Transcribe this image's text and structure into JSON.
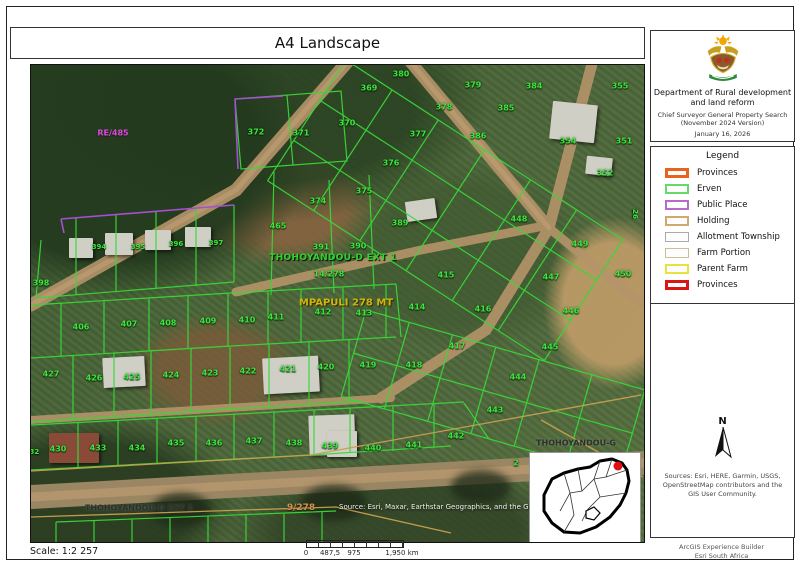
{
  "page": {
    "title": "A4 Landscape",
    "scale_label": "Scale: 1:2 257",
    "footer_right_line1": "ArcGIS Experience Builder",
    "footer_right_line2": "Esri South Africa"
  },
  "header_panel": {
    "department_line1": "Department of Rural development",
    "department_line2": "and land reform",
    "subtitle_line1": "Chief Surveyor General Property Search",
    "subtitle_line2": "(November 2024 Version)",
    "date": "January 16, 2026"
  },
  "legend": {
    "title": "Legend",
    "items": [
      {
        "label": "Provinces",
        "stroke": "#e8641e",
        "weight": 3
      },
      {
        "label": "Erven",
        "stroke": "#66d966",
        "weight": 2
      },
      {
        "label": "Public Place",
        "stroke": "#b36cc8",
        "weight": 2
      },
      {
        "label": "Holding",
        "stroke": "#d2a96c",
        "weight": 2
      },
      {
        "label": "Allotment Township",
        "stroke": "#aaaaaa",
        "weight": 1
      },
      {
        "label": "Farm Portion",
        "stroke": "#ccbf96",
        "weight": 1
      },
      {
        "label": "Parent Farm",
        "stroke": "#e8e23c",
        "weight": 2
      },
      {
        "label": "Provinces",
        "stroke": "#dd1414",
        "weight": 3
      }
    ]
  },
  "north_label": "N",
  "sources_text": "Sources: Esri, HERE, Garmin, USGS, OpenStreetMap contributors and the GIS User Community.",
  "scalebar": {
    "labels": [
      {
        "t": "0",
        "p": 0
      },
      {
        "t": "487,5",
        "p": 0.25
      },
      {
        "t": "975",
        "p": 0.5
      },
      {
        "t": "1,950 km",
        "p": 1
      }
    ]
  },
  "colors": {
    "erven_line": "#38d838",
    "public_place_line": "#a54fd2",
    "farm_line": "#c8a050",
    "parcel_label": "#3fe53f",
    "farm_name_label": "#cdb70f",
    "farm_portion_label": "#d8914d",
    "public_place_label": "#d54fd5"
  },
  "map": {
    "attribution": "Source: Esri, Maxar, Earthstar Geographics, and the GIS Use",
    "labels": [
      {
        "t": "380",
        "x": 370,
        "y": 9
      },
      {
        "t": "369",
        "x": 338,
        "y": 23
      },
      {
        "t": "379",
        "x": 442,
        "y": 20
      },
      {
        "t": "384",
        "x": 503,
        "y": 21
      },
      {
        "t": "355",
        "x": 589,
        "y": 21
      },
      {
        "t": "378",
        "x": 413,
        "y": 42
      },
      {
        "t": "385",
        "x": 475,
        "y": 43
      },
      {
        "t": "370",
        "x": 316,
        "y": 58
      },
      {
        "t": "372",
        "x": 225,
        "y": 67
      },
      {
        "t": "371",
        "x": 270,
        "y": 68
      },
      {
        "t": "377",
        "x": 387,
        "y": 69
      },
      {
        "t": "386",
        "x": 447,
        "y": 71
      },
      {
        "t": "354",
        "x": 537,
        "y": 76
      },
      {
        "t": "351",
        "x": 593,
        "y": 76
      },
      {
        "t": "376",
        "x": 360,
        "y": 98
      },
      {
        "t": "352",
        "x": 574,
        "y": 108
      },
      {
        "t": "375",
        "x": 333,
        "y": 126
      },
      {
        "t": "374",
        "x": 287,
        "y": 136
      },
      {
        "t": "26",
        "x": 604,
        "y": 149,
        "r": 90,
        "s": 7
      },
      {
        "t": "RE/485",
        "x": 82,
        "y": 68,
        "c": "m",
        "n": "public-place-label"
      },
      {
        "t": "465",
        "x": 247,
        "y": 161
      },
      {
        "t": "389",
        "x": 369,
        "y": 158
      },
      {
        "t": "448",
        "x": 488,
        "y": 154
      },
      {
        "t": "391",
        "x": 290,
        "y": 182
      },
      {
        "t": "390",
        "x": 327,
        "y": 181
      },
      {
        "t": "449",
        "x": 549,
        "y": 179
      },
      {
        "t": "394",
        "x": 68,
        "y": 182,
        "s": 7
      },
      {
        "t": "395",
        "x": 107,
        "y": 182,
        "s": 7
      },
      {
        "t": "396",
        "x": 145,
        "y": 179,
        "s": 7
      },
      {
        "t": "397",
        "x": 185,
        "y": 178,
        "s": 7
      },
      {
        "t": "THOHOYANDOU-D EXT 1",
        "x": 302,
        "y": 193,
        "c": "tg",
        "s": 9,
        "n": "township-label"
      },
      {
        "t": "14/278",
        "x": 298,
        "y": 209
      },
      {
        "t": "447",
        "x": 520,
        "y": 212
      },
      {
        "t": "415",
        "x": 415,
        "y": 210
      },
      {
        "t": "450",
        "x": 592,
        "y": 209
      },
      {
        "t": "398",
        "x": 10,
        "y": 218
      },
      {
        "t": "MPAPULI 278 MT",
        "x": 315,
        "y": 238,
        "c": "y",
        "s": 10,
        "n": "farm-name-label"
      },
      {
        "t": "414",
        "x": 386,
        "y": 242
      },
      {
        "t": "416",
        "x": 452,
        "y": 244
      },
      {
        "t": "446",
        "x": 540,
        "y": 246
      },
      {
        "t": "406",
        "x": 50,
        "y": 262
      },
      {
        "t": "407",
        "x": 98,
        "y": 259
      },
      {
        "t": "408",
        "x": 137,
        "y": 258
      },
      {
        "t": "409",
        "x": 177,
        "y": 256
      },
      {
        "t": "410",
        "x": 216,
        "y": 255
      },
      {
        "t": "411",
        "x": 245,
        "y": 252
      },
      {
        "t": "412",
        "x": 292,
        "y": 247
      },
      {
        "t": "413",
        "x": 333,
        "y": 248
      },
      {
        "t": "417",
        "x": 426,
        "y": 281
      },
      {
        "t": "445",
        "x": 519,
        "y": 282
      },
      {
        "t": "427",
        "x": 20,
        "y": 309
      },
      {
        "t": "426",
        "x": 63,
        "y": 313
      },
      {
        "t": "425",
        "x": 101,
        "y": 312
      },
      {
        "t": "424",
        "x": 140,
        "y": 310
      },
      {
        "t": "423",
        "x": 179,
        "y": 308
      },
      {
        "t": "422",
        "x": 217,
        "y": 306
      },
      {
        "t": "421",
        "x": 257,
        "y": 304
      },
      {
        "t": "420",
        "x": 295,
        "y": 302
      },
      {
        "t": "419",
        "x": 337,
        "y": 300
      },
      {
        "t": "418",
        "x": 383,
        "y": 300
      },
      {
        "t": "444",
        "x": 487,
        "y": 312
      },
      {
        "t": "443",
        "x": 464,
        "y": 345
      },
      {
        "t": "430",
        "x": 27,
        "y": 384
      },
      {
        "t": "432",
        "x": 1,
        "y": 387,
        "s": 7
      },
      {
        "t": "433",
        "x": 67,
        "y": 383
      },
      {
        "t": "434",
        "x": 106,
        "y": 383
      },
      {
        "t": "435",
        "x": 145,
        "y": 378
      },
      {
        "t": "436",
        "x": 183,
        "y": 378
      },
      {
        "t": "437",
        "x": 223,
        "y": 376
      },
      {
        "t": "438",
        "x": 263,
        "y": 378
      },
      {
        "t": "439",
        "x": 299,
        "y": 381
      },
      {
        "t": "440",
        "x": 342,
        "y": 383
      },
      {
        "t": "441",
        "x": 383,
        "y": 380
      },
      {
        "t": "442",
        "x": 425,
        "y": 371
      },
      {
        "t": "2",
        "x": 485,
        "y": 398
      },
      {
        "t": "THOHOYANDOU-G",
        "x": 545,
        "y": 378,
        "c": "d",
        "s": 8,
        "n": "township-label-right"
      },
      {
        "t": "THOHOYANDOU-D EXT 1",
        "x": 108,
        "y": 443,
        "c": "d",
        "s": 8,
        "n": "township-label-bottom"
      },
      {
        "t": "9/278",
        "x": 270,
        "y": 443,
        "c": "o",
        "s": 9,
        "n": "farm-portion-label"
      }
    ]
  }
}
